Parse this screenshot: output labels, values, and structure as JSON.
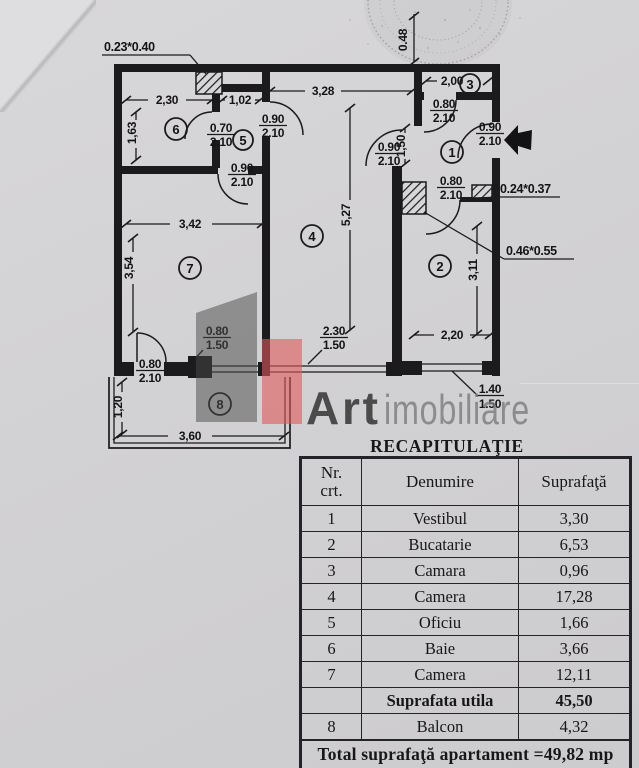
{
  "document": {
    "title": "RECAPITULAŢIE",
    "watermark": {
      "bold": "Art",
      "light": "imobiliare"
    },
    "colors": {
      "watermark_red": "#e05a5c",
      "watermark_gray": "#5a5a58",
      "paper": "#d2d1d3",
      "ink": "#1b1b1d"
    }
  },
  "plan": {
    "room_numbers": [
      "1",
      "2",
      "3",
      "4",
      "5",
      "6",
      "7",
      "8"
    ],
    "dims": {
      "bath_w": "2,30",
      "oficiu_w": "1,02",
      "bath_h": "1,63",
      "hall_w": "3,28",
      "camara_w": "2,00",
      "camara_d": "0.48",
      "vestibul_w": "1,50",
      "camera4_h": "5,27",
      "camera7_w": "3,42",
      "camera7_h": "3,54",
      "bucatarie_h": "3,11",
      "bucatarie_w": "2,20",
      "balcon_h": "1,20",
      "balcon_w": "3,60"
    },
    "openings": {
      "bath_door": {
        "w": "0.70",
        "h": "2.10"
      },
      "hall_door": {
        "w": "0.90",
        "h": "2.10"
      },
      "room7_door": {
        "w": "0.90",
        "h": "2.10"
      },
      "room4_door": {
        "w": "0.90",
        "h": "2.10"
      },
      "camara_door": {
        "w": "0.80",
        "h": "2.10"
      },
      "entrance_door": {
        "w": "0.90",
        "h": "2.10"
      },
      "kitchen_door": {
        "w": "0.80",
        "h": "2.10"
      },
      "balcony_door": {
        "w": "0.80",
        "h": "2.10"
      },
      "room7_window": {
        "w": "0.80",
        "h": "1.50"
      },
      "room4_window": {
        "w": "2.30",
        "h": "1.50"
      },
      "kitchen_window": {
        "w": "1.40",
        "h": "1.50"
      }
    },
    "flues": {
      "top": "0.23*0.40",
      "small": "0.24*0.37",
      "large": "0.46*0.55"
    }
  },
  "table": {
    "headers": [
      "Nr.\ncrt.",
      "Denumire",
      "Suprafaţă"
    ],
    "rows": [
      {
        "nr": "1",
        "name": "Vestibul",
        "area": "3,30"
      },
      {
        "nr": "2",
        "name": "Bucatarie",
        "area": "6,53"
      },
      {
        "nr": "3",
        "name": "Camara",
        "area": "0,96"
      },
      {
        "nr": "4",
        "name": "Camera",
        "area": "17,28"
      },
      {
        "nr": "5",
        "name": "Oficiu",
        "area": "1,66"
      },
      {
        "nr": "6",
        "name": "Baie",
        "area": "3,66"
      },
      {
        "nr": "7",
        "name": "Camera",
        "area": "12,11"
      },
      {
        "nr": "",
        "name": "Suprafata utila",
        "area": "45,50"
      },
      {
        "nr": "8",
        "name": "Balcon",
        "area": "4,32"
      }
    ],
    "total": "Total suprafaţă apartament =49,82 mp"
  }
}
